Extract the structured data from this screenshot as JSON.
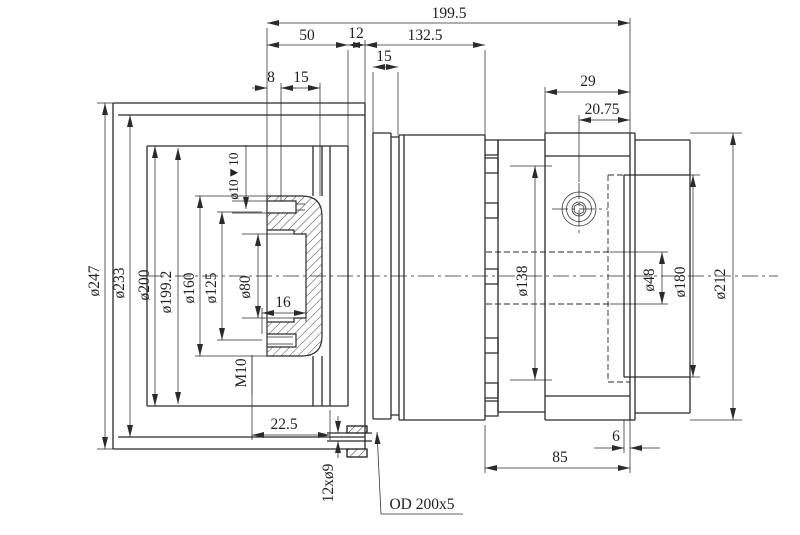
{
  "drawing": {
    "type": "engineering-section-drawing",
    "background_color": "#ffffff",
    "line_color": "#2b2b2b",
    "dims": {
      "overall": "199.5",
      "l50": "50",
      "l12": "12",
      "l132": "132.5",
      "l15a": "15",
      "l8": "8",
      "l15b": "15",
      "l29": "29",
      "l2075": "20.75",
      "d247": "ø247",
      "d233": "ø233",
      "d200": "ø200",
      "d1992": "ø199.2",
      "d160": "ø160",
      "d125": "ø125",
      "d80": "ø80",
      "cbore": "ø10▼10",
      "l16": "16",
      "m10": "M10",
      "l225": "22.5",
      "holes": "12xø9",
      "oring": "OD 200x5",
      "d138": "ø138",
      "d48": "ø48",
      "d180": "ø180",
      "d212": "ø212",
      "l85": "85",
      "l6": "6"
    }
  }
}
